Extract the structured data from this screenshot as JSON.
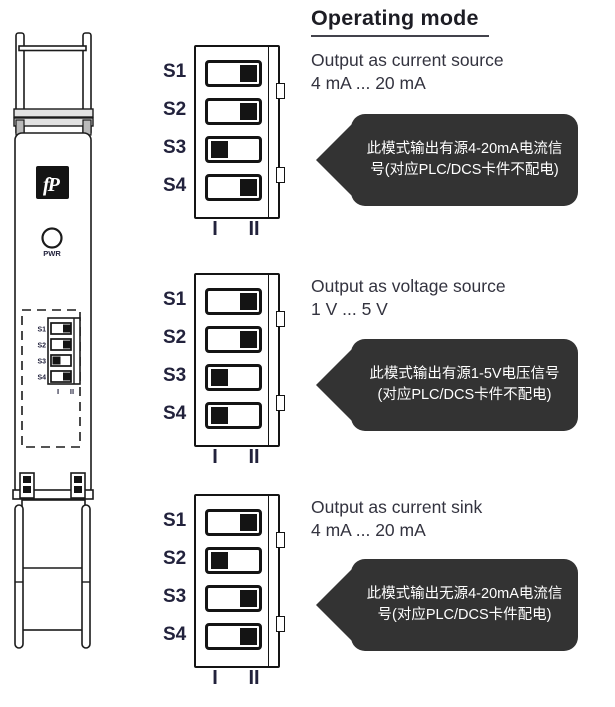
{
  "title": "Operating mode",
  "colors": {
    "callout_bg": "#333333",
    "label_navy": "#22223c"
  },
  "device": {
    "logo_text": "fP",
    "pwr_label": "PWR",
    "dip": {
      "switches": [
        {
          "label": "S1",
          "position": "II"
        },
        {
          "label": "S2",
          "position": "II"
        },
        {
          "label": "S3",
          "position": "I"
        },
        {
          "label": "S4",
          "position": "II"
        }
      ],
      "scale": {
        "first": "I",
        "second": "II"
      }
    }
  },
  "modes": [
    {
      "name": "Output as current source",
      "range": "4 mA ... 20 mA",
      "switches": [
        {
          "label": "S1",
          "position": "II"
        },
        {
          "label": "S2",
          "position": "II"
        },
        {
          "label": "S3",
          "position": "I"
        },
        {
          "label": "S4",
          "position": "II"
        }
      ],
      "scale": {
        "first": "I",
        "second": "II"
      },
      "callout": "此模式输出有源4-20mA电流信号(对应PLC/DCS卡件不配电)"
    },
    {
      "name": "Output as voltage source",
      "range": "1 V ... 5 V",
      "switches": [
        {
          "label": "S1",
          "position": "II"
        },
        {
          "label": "S2",
          "position": "II"
        },
        {
          "label": "S3",
          "position": "I"
        },
        {
          "label": "S4",
          "position": "I"
        }
      ],
      "scale": {
        "first": "I",
        "second": "II"
      },
      "callout": "此模式输出有源1-5V电压信号(对应PLC/DCS卡件不配电)"
    },
    {
      "name": "Output as current sink",
      "range": "4 mA ... 20 mA",
      "switches": [
        {
          "label": "S1",
          "position": "II"
        },
        {
          "label": "S2",
          "position": "I"
        },
        {
          "label": "S3",
          "position": "II"
        },
        {
          "label": "S4",
          "position": "II"
        }
      ],
      "scale": {
        "first": "I",
        "second": "II"
      },
      "callout": "此模式输出无源4-20mA电流信号(对应PLC/DCS卡件配电)"
    }
  ]
}
